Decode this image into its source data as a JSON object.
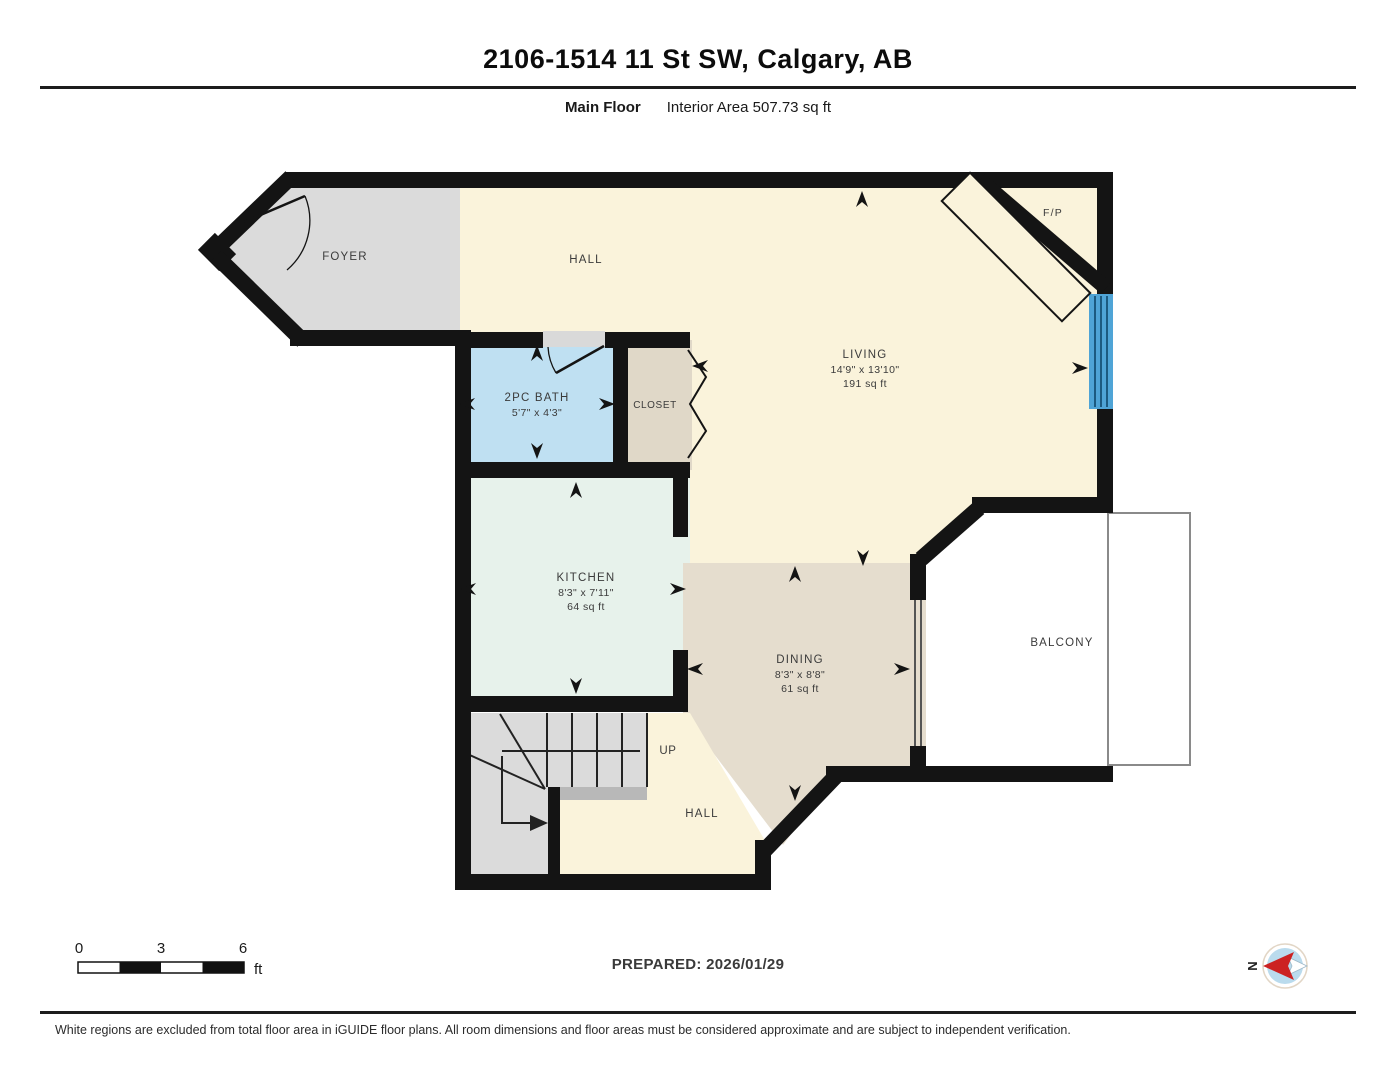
{
  "header": {
    "title": "2106-1514 11 St SW, Calgary, AB",
    "floor_label": "Main Floor",
    "area_label": "Interior Area 507.73 sq ft"
  },
  "rooms": {
    "foyer": {
      "name": "FOYER"
    },
    "hall_upper": {
      "name": "HALL"
    },
    "bath": {
      "name": "2PC BATH",
      "dims": "5'7\" x 4'3\""
    },
    "closet": {
      "name": "CLOSET"
    },
    "living": {
      "name": "LIVING",
      "dims": "14'9\" x 13'10\"",
      "area": "191 sq ft"
    },
    "fireplace": {
      "name": "F/P"
    },
    "kitchen": {
      "name": "KITCHEN",
      "dims": "8'3\" x 7'11\"",
      "area": "64 sq ft"
    },
    "dining": {
      "name": "DINING",
      "dims": "8'3\" x 8'8\"",
      "area": "61 sq ft"
    },
    "balcony": {
      "name": "BALCONY"
    },
    "stairs": {
      "label": "UP"
    },
    "hall_lower": {
      "name": "HALL"
    }
  },
  "scale_bar": {
    "ticks": [
      "0",
      "3",
      "6"
    ],
    "unit": "ft"
  },
  "compass": {
    "label": "N"
  },
  "footer": {
    "prepared": "PREPARED: 2026/01/29",
    "disclaimer": "White regions are excluded from total floor area in iGUIDE floor plans. All room dimensions and floor areas must be considered approximate and are subject to independent verification."
  },
  "icons": {
    "compass_icon": "north-arrow-compass",
    "measure_arrow_icon": "room-dimension-extent-arrow",
    "door_arc_icon": "door-swing",
    "bifold_icon": "bifold-closet-door",
    "window_color": "#4fa4d6"
  },
  "colors": {
    "wall": "#141414",
    "hall_living_fill": "#faf3db",
    "foyer_stairs_fill": "#dbdbdb",
    "bath_fill": "#bfe0f2",
    "closet_fill": "#e0d8c8",
    "dining_fill": "#e5ddce",
    "kitchen_fill": "#e7f2eb",
    "window_blue": "#4fa4d6",
    "compass_red": "#cc2222",
    "compass_blue": "#badbed",
    "balcony_border": "#8a8a8a"
  }
}
